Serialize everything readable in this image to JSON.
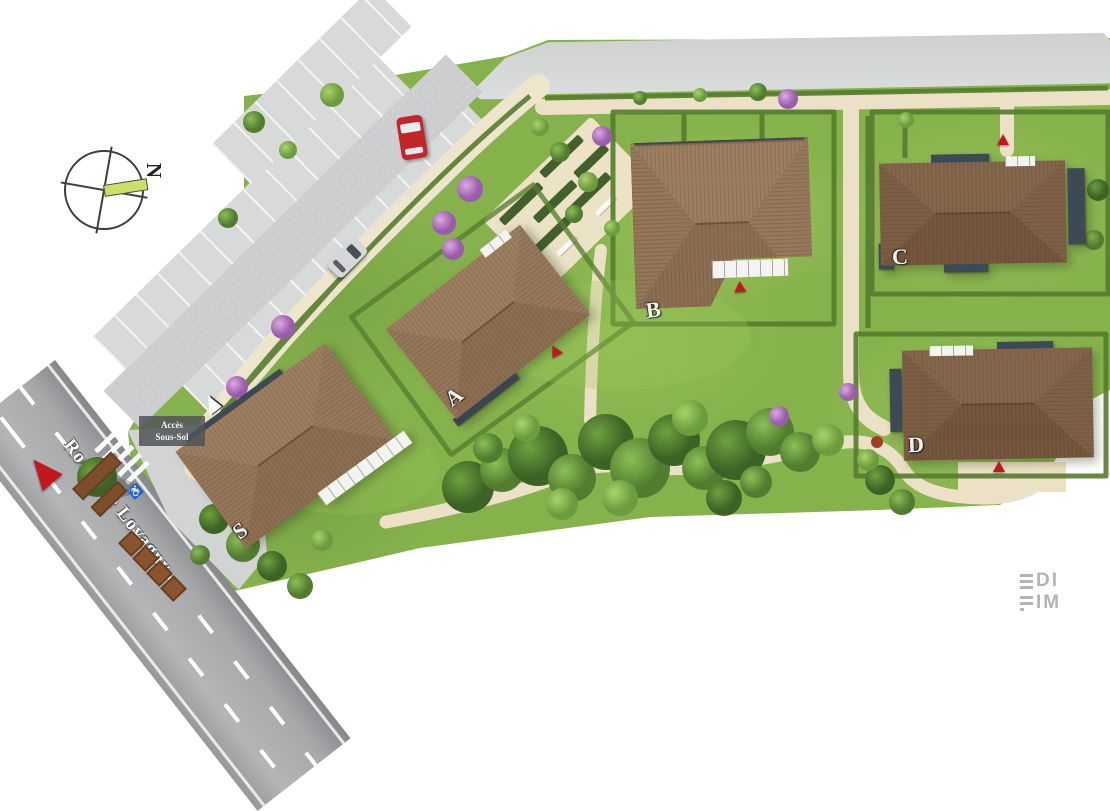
{
  "site_plan": {
    "compass": {
      "north_label": "N"
    },
    "road": {
      "name": "Route de Lovagny"
    },
    "signs": {
      "basement_access": "Accès\nSous-Sol"
    },
    "buildings": [
      {
        "label": "S"
      },
      {
        "label": "A"
      },
      {
        "label": "B"
      },
      {
        "label": "C"
      },
      {
        "label": "D"
      }
    ],
    "logo": {
      "line1": "EDI",
      "line2": "FIM",
      "line1_rest": "DI",
      "line2_rest": "IM"
    },
    "colors": {
      "lawn_green": "#86b24c",
      "hedge_green": "#567c2e",
      "path_beige": "#ece1c6",
      "road_gray": "#a8a9ab",
      "parking_gray": "#d8dad9",
      "roof_brown": "#8c6e52",
      "facade_slate": "#3d4954",
      "marker_red": "#c4161c",
      "blossom_purple": "#b07cc3",
      "compass_needle": "#cddf66",
      "logo_gray": "#b4b4b7"
    }
  }
}
